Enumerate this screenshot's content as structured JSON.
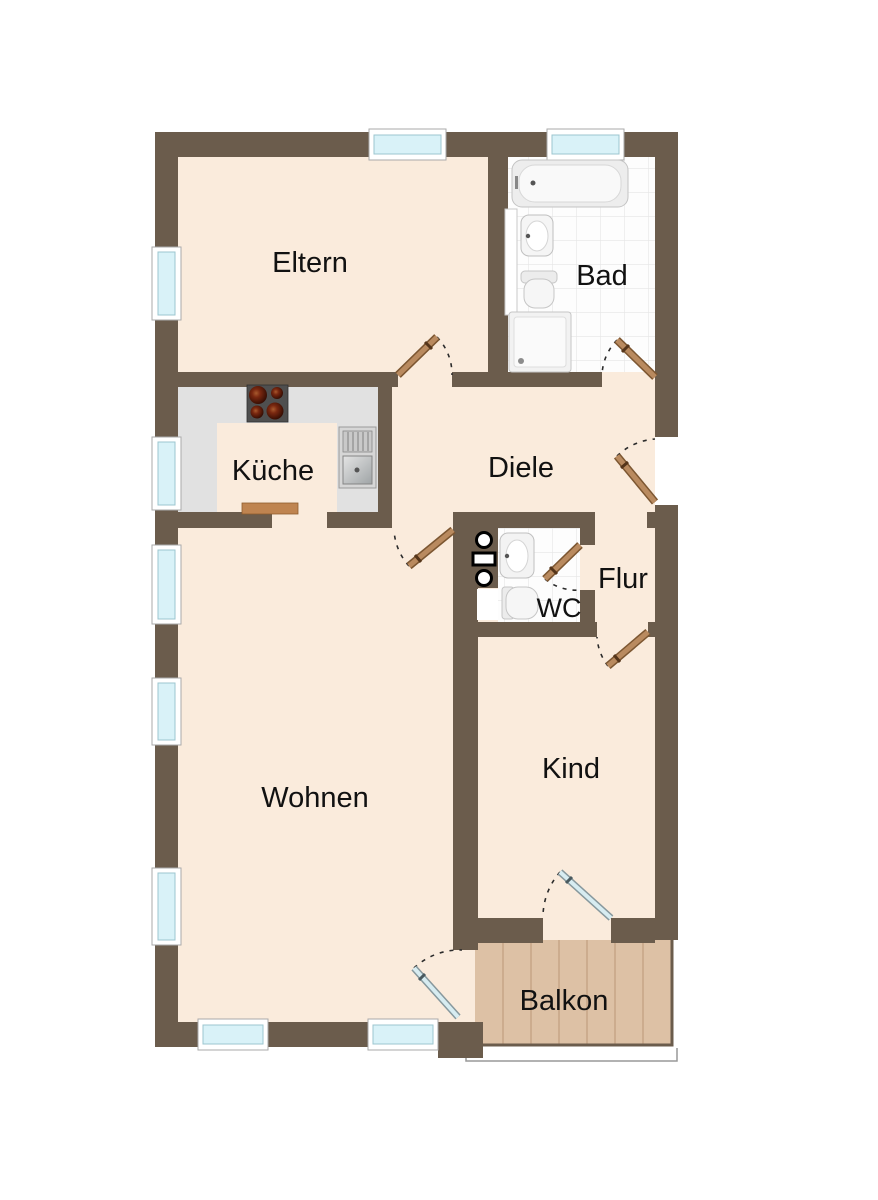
{
  "plan": {
    "type": "apartment-floor-plan",
    "rooms": {
      "eltern": {
        "label": "Eltern"
      },
      "bad": {
        "label": "Bad"
      },
      "kueche": {
        "label": "Küche"
      },
      "diele": {
        "label": "Diele"
      },
      "flur": {
        "label": "Flur"
      },
      "wc": {
        "label": "WC"
      },
      "wohnen": {
        "label": "Wohnen"
      },
      "kind": {
        "label": "Kind"
      },
      "balkon": {
        "label": "Balkon"
      }
    },
    "colors": {
      "wall": "#6b5c4c",
      "floor": "#faebdc",
      "kitchen_counter_area": "#e1e1e1",
      "window_glass": "#d9f2f8",
      "balcony_wood": "#ddc1a5",
      "door_wood": "#b98a5f",
      "glass_door": "#d7ecf1",
      "pass_counter": "#bf8450",
      "tile": "#fdfdfd",
      "label_text": "#111111"
    }
  }
}
